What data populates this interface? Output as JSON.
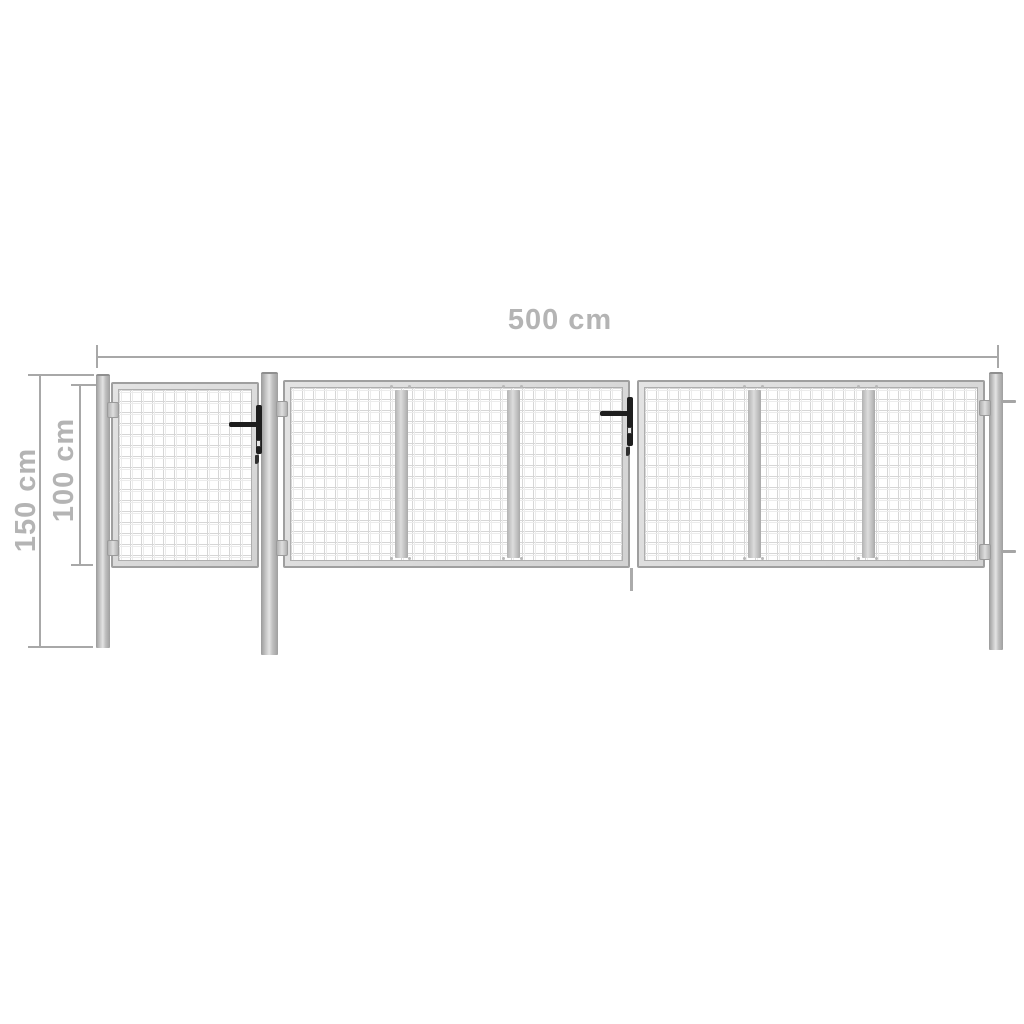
{
  "image_type": "product-dimension-diagram",
  "subject": "Silver steel garden gate with wire-mesh panels: one single gate and a wide double gate hung on three round posts, front elevation with dimension arrows",
  "dimensions": {
    "width": {
      "label": "500 cm"
    },
    "post_height": {
      "label": "150 cm"
    },
    "gate_height": {
      "label": "100 cm"
    }
  },
  "colors": {
    "background": "#ffffff",
    "dimension_line": "#a8a8a8",
    "dimension_text": "#b4b4b4",
    "steel_dark": "#9a9a9a",
    "steel_light": "#e3e3e3",
    "frame_fill": "#d8d8d8",
    "mesh_line": "#d6d6d6",
    "handle_black": "#1e1e1e"
  },
  "parts": {
    "posts": [
      {
        "name": "left-post"
      },
      {
        "name": "center-post"
      },
      {
        "name": "right-post"
      }
    ],
    "gates": [
      {
        "name": "single-gate",
        "mesh": "square wire mesh",
        "panels": 1
      },
      {
        "name": "double-gate-left-leaf",
        "mesh": "square wire mesh",
        "panels": 3
      },
      {
        "name": "double-gate-right-leaf",
        "mesh": "square wire mesh",
        "panels": 3
      }
    ],
    "hardware": [
      {
        "name": "single-gate-handle"
      },
      {
        "name": "double-gate-handle"
      },
      {
        "name": "hinges"
      },
      {
        "name": "center-drop-rod"
      }
    ]
  }
}
